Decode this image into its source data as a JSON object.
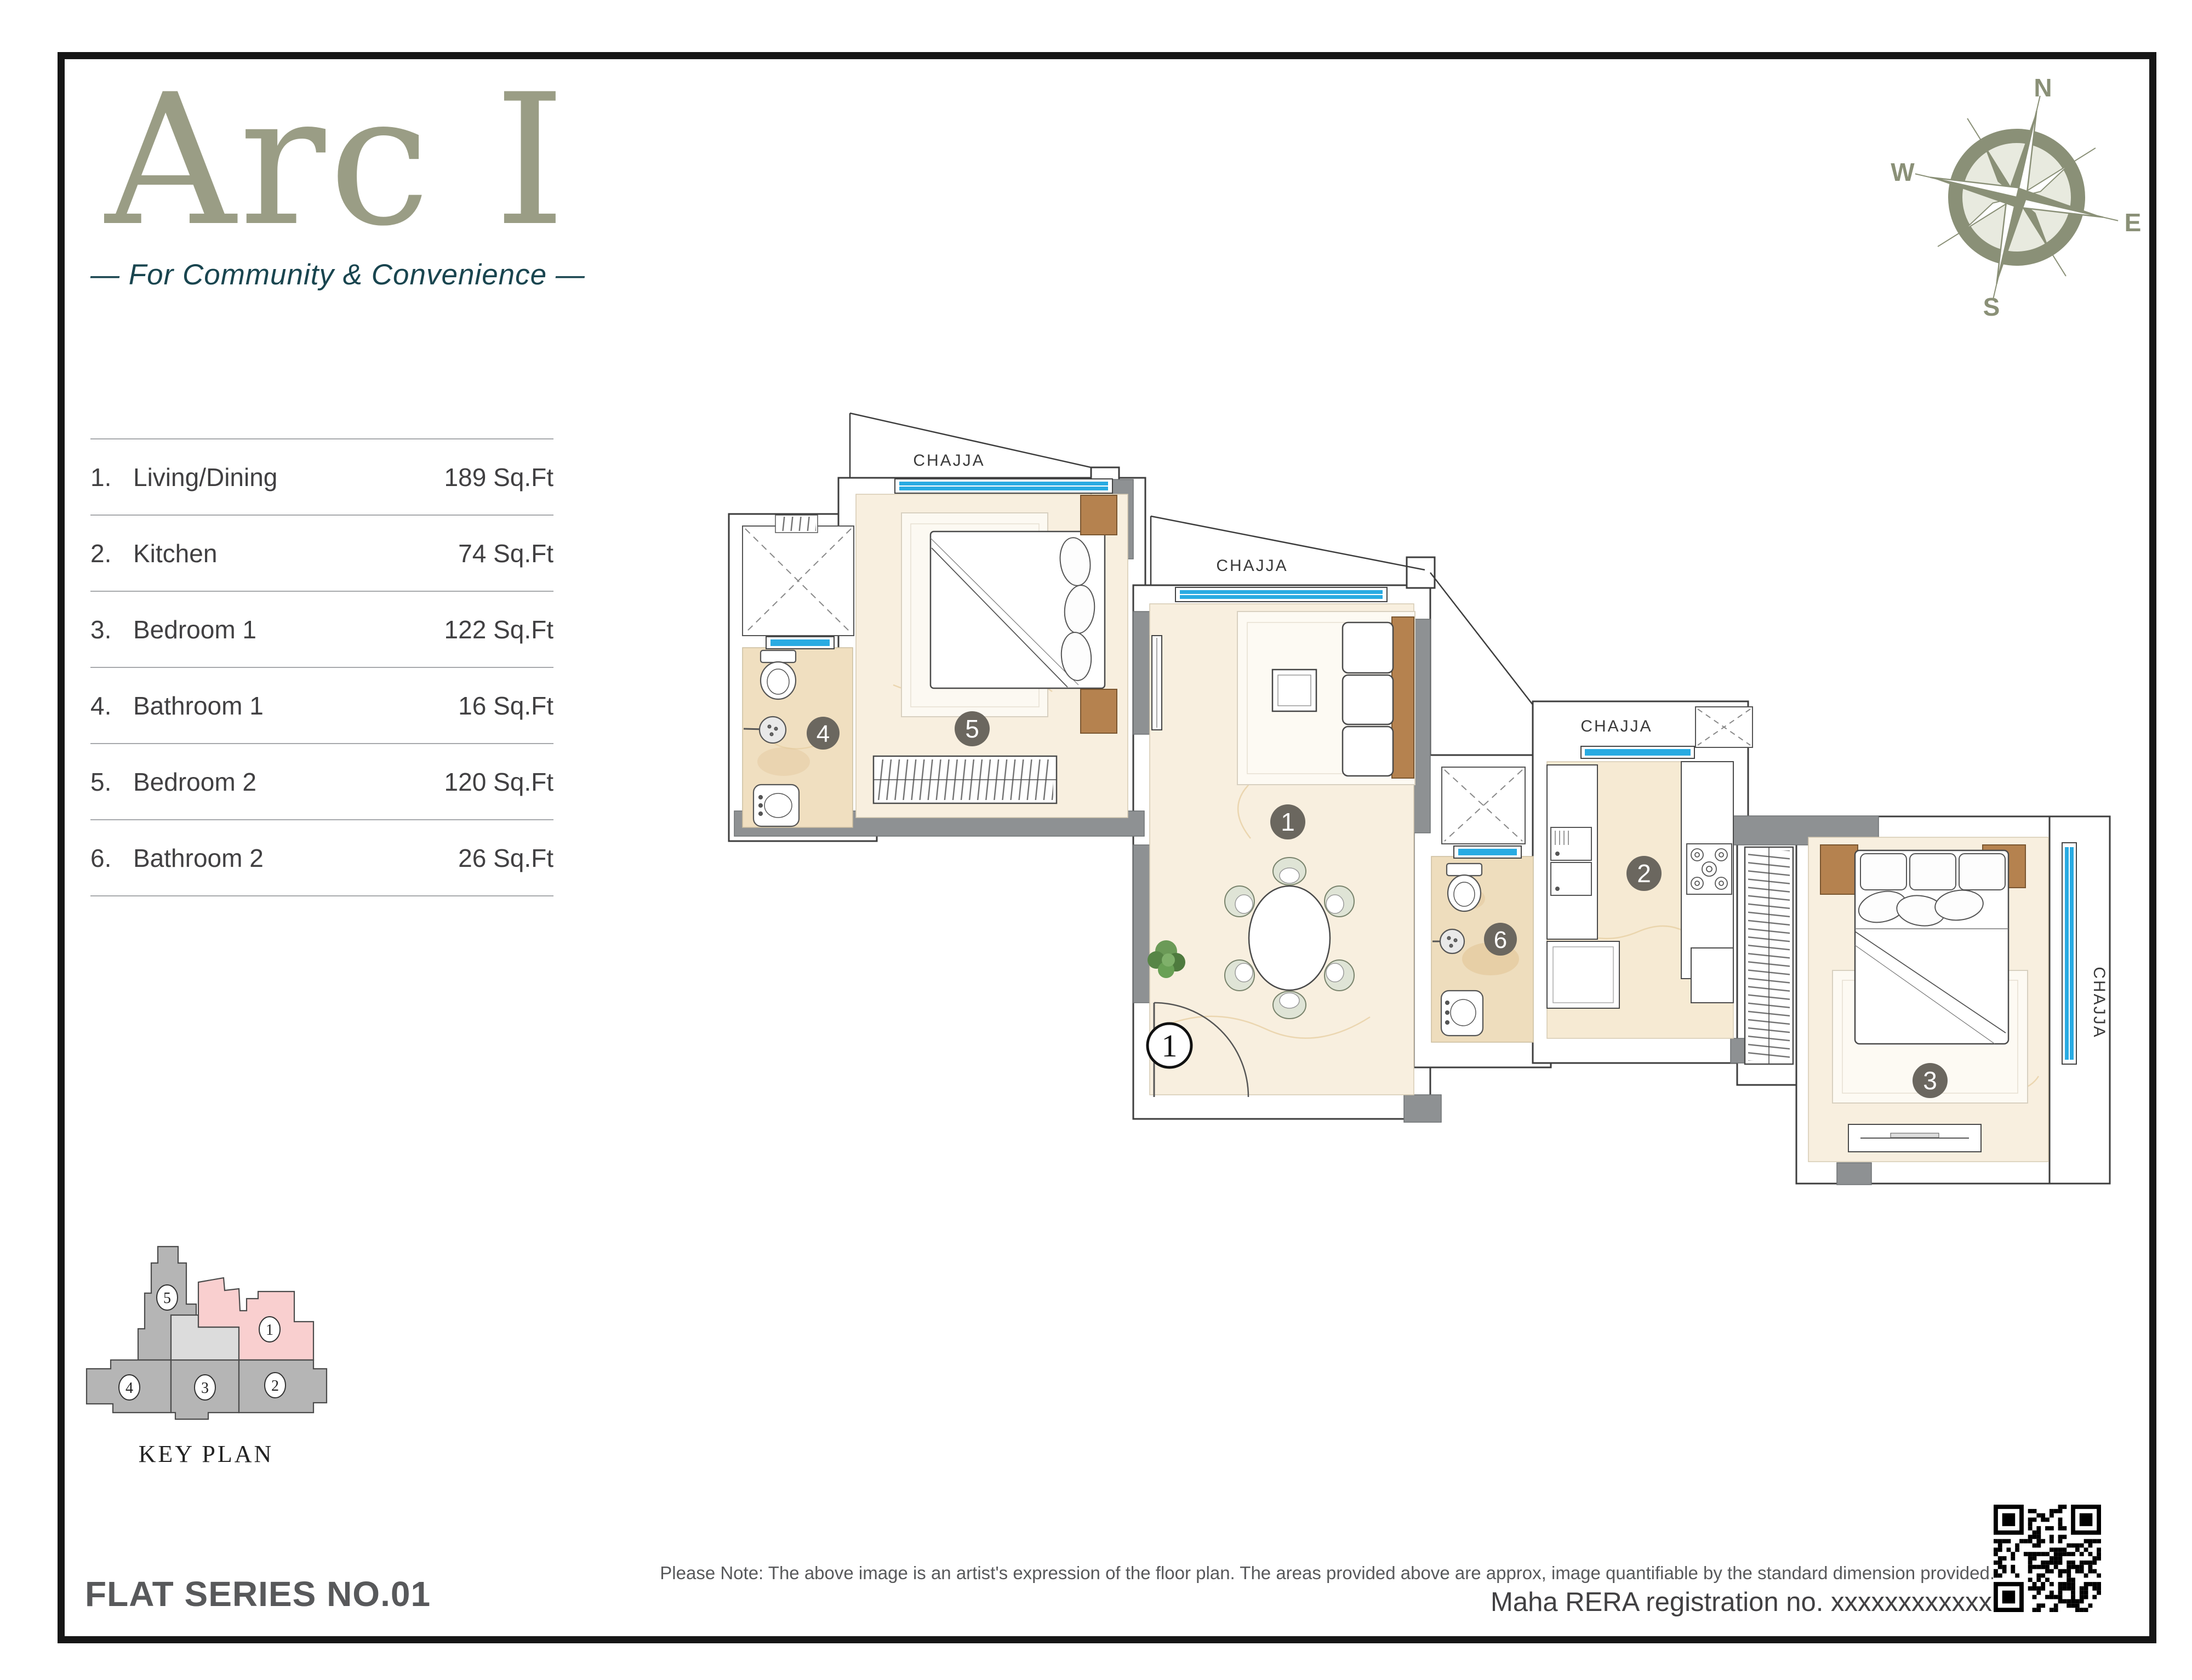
{
  "brand": {
    "title": "Arc I",
    "tagline": "— For Community & Convenience —",
    "title_color": "#9a9d85",
    "tagline_color": "#19454f"
  },
  "compass": {
    "n": "N",
    "e": "E",
    "s": "S",
    "w": "W",
    "color": "#8a9077"
  },
  "room_table": {
    "rows": [
      {
        "no": "1.",
        "name": "Living/Dining",
        "area": "189 Sq.Ft"
      },
      {
        "no": "2.",
        "name": "Kitchen",
        "area": "74 Sq.Ft"
      },
      {
        "no": "3.",
        "name": "Bedroom 1",
        "area": "122 Sq.Ft"
      },
      {
        "no": "4.",
        "name": "Bathroom 1",
        "area": "16 Sq.Ft"
      },
      {
        "no": "5.",
        "name": "Bedroom 2",
        "area": "120 Sq.Ft"
      },
      {
        "no": "6.",
        "name": "Bathroom 2",
        "area": "26 Sq.Ft"
      }
    ]
  },
  "floor_plan": {
    "chajja_label": "CHAJJA",
    "entrance_label": "1",
    "markers": [
      "1",
      "2",
      "3",
      "4",
      "5",
      "6"
    ],
    "window_color": "#29abe2",
    "wall_gray": "#8e9193",
    "floor_beige": "#f8efdf",
    "floor_tan": "#f0dfc0",
    "wood_color": "#b5824f",
    "marker_color": "#6b675f"
  },
  "key_plan": {
    "title": "KEY PLAN",
    "units": [
      "1",
      "2",
      "3",
      "4",
      "5"
    ],
    "highlighted_unit": "1",
    "highlight_color": "#f9cfcf",
    "unit_gray": "#b5b5b5",
    "unit_light": "#dcdcdc"
  },
  "footer": {
    "flat_series": "FLAT SERIES NO.01",
    "note": "Please Note: The above image is an artist's expression of the floor plan. The areas provided above are approx, image quantifiable by the standard dimension provided.",
    "rera": "Maha RERA registration no. xxxxxxxxxxxx"
  }
}
